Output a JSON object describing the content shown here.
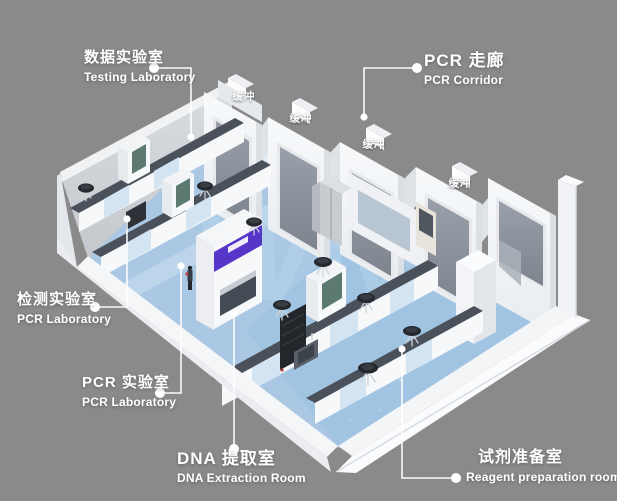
{
  "scene": {
    "description": "Isometric 3D render of a PCR laboratory suite floor plan",
    "background_color": "#8a8a8a",
    "floor_color": "#a9c7e2",
    "corridor_floor_color": "#e3edf5",
    "wall_color": "#f4f6f8",
    "window_glass_color": "#8e959e",
    "bench_top_color": "#4a515b",
    "door_accent_color": "#5636c9",
    "label_text_color": "#ffffff"
  },
  "watermark": {
    "text": "WN"
  },
  "callouts": [
    {
      "id": "testing-laboratory",
      "zh": "数据实验室",
      "en": "Testing Laboratory"
    },
    {
      "id": "pcr-corridor",
      "zh": "PCR 走廊",
      "en": "PCR Corridor"
    },
    {
      "id": "detection-laboratory",
      "zh": "检测实验室",
      "en": "PCR Laboratory"
    },
    {
      "id": "pcr-laboratory",
      "zh": "PCR 实验室",
      "en": "PCR Laboratory"
    },
    {
      "id": "dna-extraction-room",
      "zh": "DNA 提取室",
      "en": "DNA Extraction Room"
    },
    {
      "id": "reagent-preparation-room",
      "zh": "试剂准备室",
      "en": "Reagent preparation room"
    }
  ],
  "buffer_rooms": [
    {
      "label": "缓冲"
    },
    {
      "label": "缓冲"
    },
    {
      "label": "缓冲"
    },
    {
      "label": "缓冲"
    }
  ]
}
